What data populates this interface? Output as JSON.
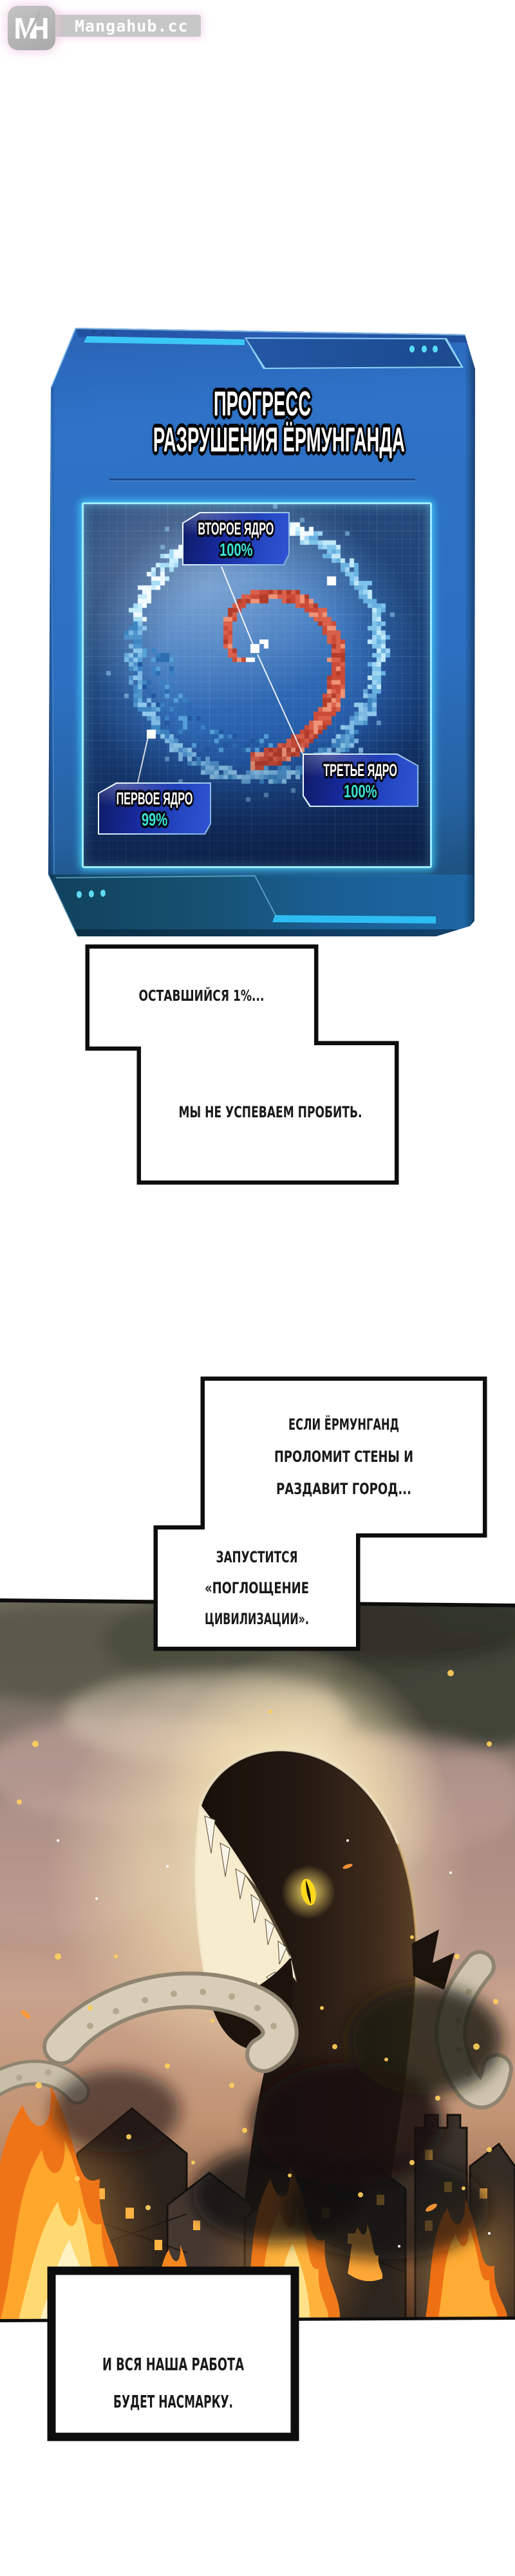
{
  "site": {
    "logo_m": "M",
    "logo_h": "H",
    "logo_text": "Mangahub.cc"
  },
  "progress_panel": {
    "title_lines": [
      "ПРОГРЕСС",
      "РАЗРУШЕНИЯ ЁРМУНГАНДА"
    ],
    "cores": [
      {
        "label": "ВТОРОЕ ЯДРО",
        "value": "100%"
      },
      {
        "label": "ПЕРВОЕ ЯДРО",
        "value": "99%"
      },
      {
        "label": "ТРЕТЬЕ ЯДРО",
        "value": "100%"
      }
    ],
    "colors": {
      "panel_body": "#2d72c4",
      "accent_stripe": "#3cc8f6",
      "screen_border": "#9dedff",
      "core_value": "#3be4d6",
      "badge_fill": "#16299a",
      "spiral_ring": "#a6dcf6",
      "spiral_core": "#d9604a"
    }
  },
  "speech_bubbles": [
    {
      "lines": [
        "ОСТАВШИЙСЯ 1%..."
      ]
    },
    {
      "lines": [
        "МЫ НЕ УСПЕВАЕМ ПРОБИТЬ."
      ]
    },
    {
      "lines": [
        "ЕСЛИ ЁРМУНГАНД",
        "ПРОЛОМИТ СТЕНЫ И",
        "РАЗДАВИТ ГОРОД..."
      ]
    },
    {
      "lines": [
        "ЗАПУСТИТСЯ",
        "«ПОГЛОЩЕНИЕ",
        "ЦИВИЛИЗАЦИИ»."
      ]
    },
    {
      "lines": [
        "И ВСЯ НАША РАБОТА",
        "БУДЕТ НАСМАРКУ."
      ]
    }
  ]
}
